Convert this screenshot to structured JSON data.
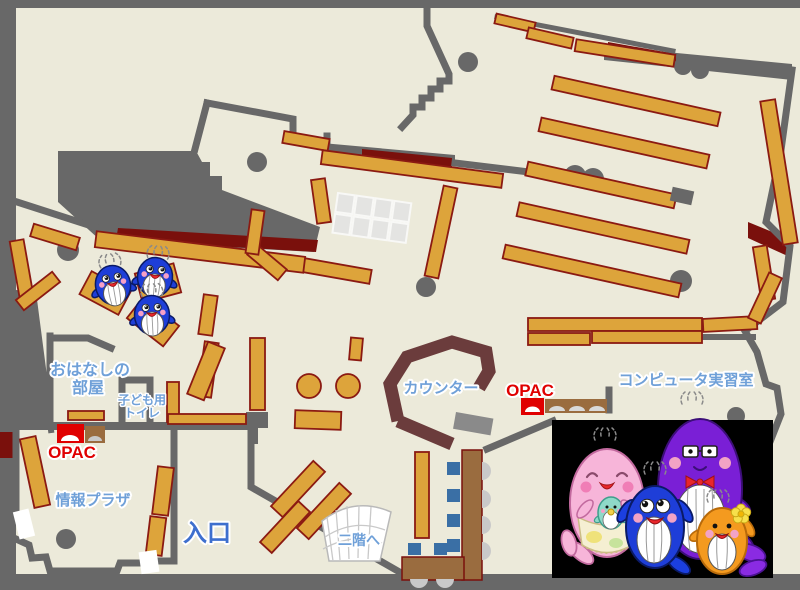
{
  "page": {
    "type": "library-floor-map"
  },
  "labels": {
    "storytelling_room": [
      "おはなしの",
      "部屋"
    ],
    "kids_toilet": [
      "子ども用",
      "トイレ"
    ],
    "opac_left": "OPAC",
    "opac_right": "OPAC",
    "info_plaza": "情報プラザ",
    "entrance": "入口",
    "to_second_floor": "二階へ",
    "counter": "カウンター",
    "computer_room": "コンピュータ実習室"
  },
  "colors": {
    "floor": "#ECEADA",
    "wall_gray": "#686868",
    "shelf_orange": "#DDA43B",
    "shelf_border": "#8B1A12",
    "dark_red": "#7A100C",
    "counter_brown": "#6B3C3C",
    "desk_brown": "#9A6C3F",
    "chair_blue": "#3A6FA5",
    "label_blue": "#6FA0D8",
    "entrance_blue": "#3E6FCE",
    "opac_red": "#E00000",
    "photo_black": "#000000",
    "whale_blue": "#1E3ED8",
    "whale_pink": "#F7B5D9",
    "whale_purple": "#7A1FD6",
    "whale_orange": "#F49A1F",
    "whale_baby_green": "#8FD9C8"
  },
  "mascots": {
    "children_area": [
      "blue-whale-plush",
      "blue-whale-plush",
      "blue-whale-plush"
    ],
    "family": [
      "pink-mother-whale-with-baby",
      "blue-child-whale",
      "purple-father-whale",
      "orange-child-whale"
    ]
  }
}
